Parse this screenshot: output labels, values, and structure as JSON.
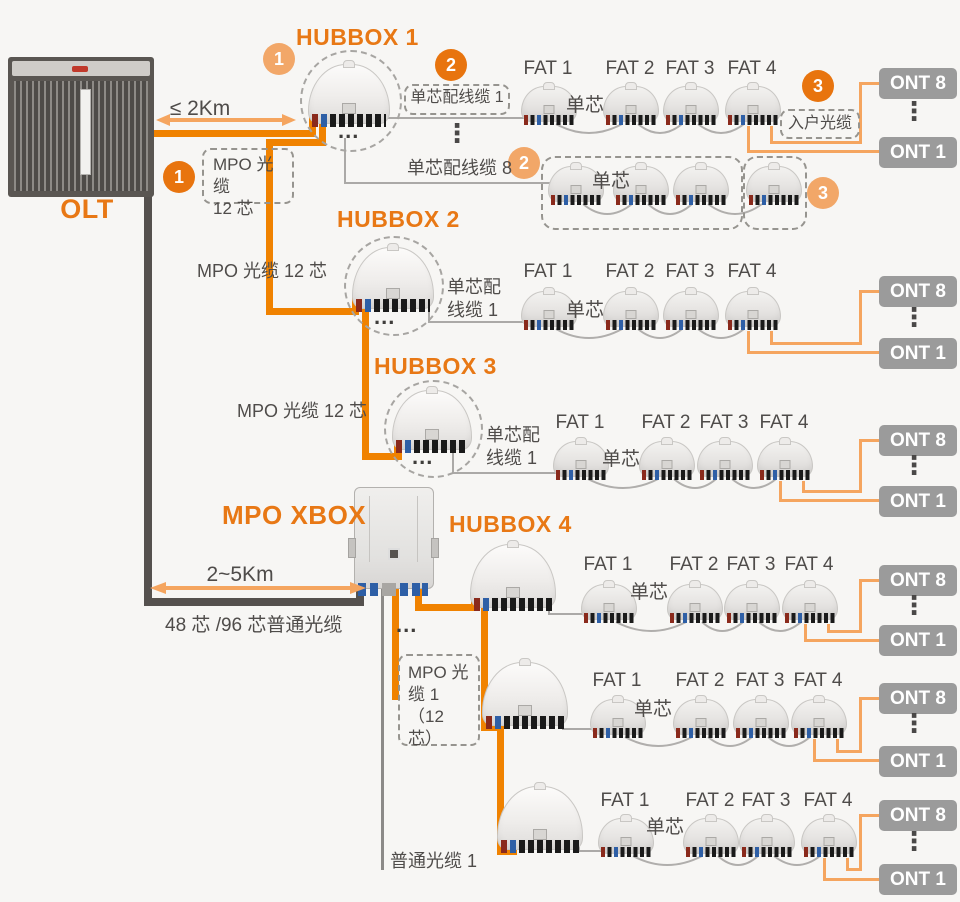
{
  "colors": {
    "accent_orange": "#E87815",
    "cable_orange": "#F08200",
    "light_orange": "#F5A55F",
    "dark_cable": "#55514E",
    "ont_gray": "#9B9B9B",
    "text_gray": "#4F4C4A"
  },
  "labels": {
    "olt": "OLT",
    "hubbox1": "HUBBOX 1",
    "hubbox2": "HUBBOX 2",
    "hubbox3": "HUBBOX 3",
    "hubbox4": "HUBBOX 4",
    "mpo_xbox": "MPO XBOX"
  },
  "badges": {
    "one": "1",
    "two": "2",
    "three": "3"
  },
  "distances": {
    "olt_hubbox": "≤ 2Km",
    "olt_xbox": "2~5Km"
  },
  "cables": {
    "mpo_12_box": "MPO 光缆\n12 芯",
    "mpo_12_plain": "MPO 光缆 12 芯",
    "single_core_patch_1": "单芯配线缆 1",
    "single_core_patch_8": "单芯配线缆 8",
    "single_core_patch_1_wrapped": "单芯配\n线缆 1",
    "home_drop": "入户光缆",
    "single_core": "单芯",
    "mpo_1_12_box": "MPO 光\n缆 1\n（12 芯）",
    "common_48_96": "48 芯 /96 芯普通光缆",
    "common_1": "普通光缆 1"
  },
  "fat": [
    "FAT 1",
    "FAT 2",
    "FAT 3",
    "FAT 4"
  ],
  "ont": {
    "top": "ONT 8",
    "bottom": "ONT 1"
  },
  "misc": {
    "ellipsis": "...",
    "vdots": "⋮"
  }
}
